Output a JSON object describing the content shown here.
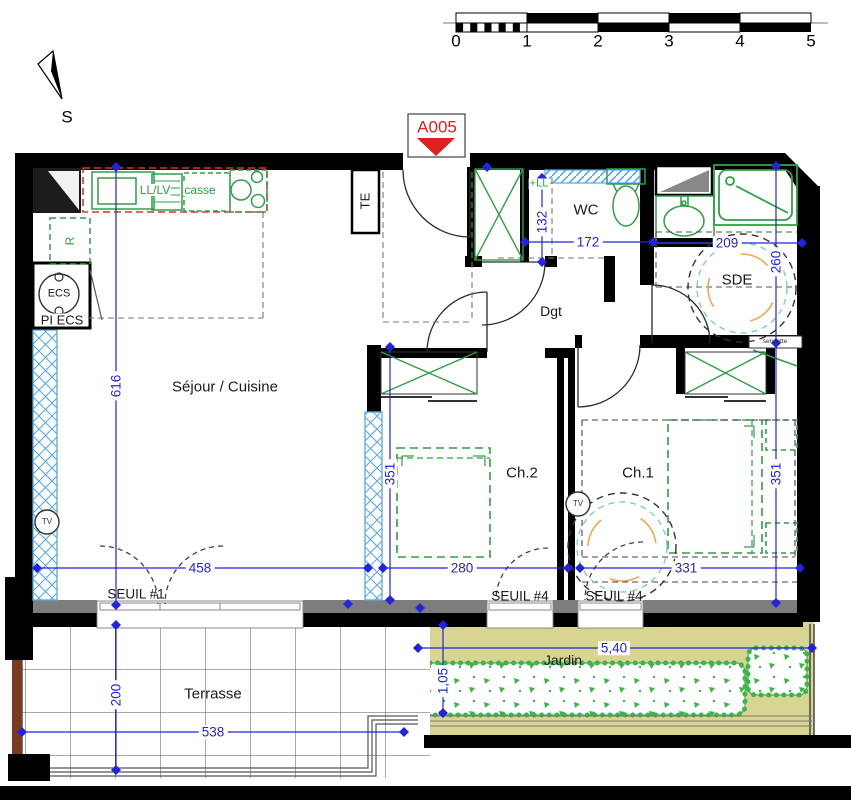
{
  "marker": {
    "plan_id": "A005"
  },
  "compass": {
    "label": "S"
  },
  "scale_bar": {
    "ticks": [
      "0",
      "1",
      "2",
      "3",
      "4",
      "5"
    ]
  },
  "rooms": {
    "sejour_cuisine": "Séjour / Cuisine",
    "wc": "WC",
    "sde": "SDE",
    "dgt": "Dgt",
    "ch2": "Ch.2",
    "ch1": "Ch.1",
    "terrasse": "Terrasse",
    "jardin": "Jardin"
  },
  "fixtures": {
    "electrical_panel": "TE",
    "washer_dishwasher": "LL/LV",
    "pot_drawer": "casse",
    "fridge": "R",
    "water_heater": "ECS",
    "water_heater_closet": "PI ECS",
    "washer_slot": "+LL",
    "tv_outlet_1": "TV",
    "tv_outlet_2": "TV",
    "towel_rail": "serviette"
  },
  "thresholds": {
    "seuil_1": "SEUIL #1",
    "seuil_4a": "SEUIL #4",
    "seuil_4b": "SEUIL #4"
  },
  "dims": {
    "sejour_height": "616",
    "washer_width": "132",
    "wc_width": "172",
    "sde_width": "209",
    "sde_height": "260",
    "ch2_height": "351",
    "ch2_width": "280",
    "ch1_width": "331",
    "ch1_height": "351",
    "sejour_width": "458",
    "terrasse_width": "538",
    "terrasse_height": "200",
    "jardin_width": "5,40",
    "jardin_depth": "1,05"
  },
  "colors": {
    "dim_blue": "#2323dd",
    "fixture_green": "#2fa044",
    "marker_red": "#e02020",
    "window_blue": "#58a8e8",
    "garden_khaki": "#d8d492",
    "hedge_green": "#3cb54a",
    "wall_black": "#000000",
    "wall_gray": "#7d7d7d",
    "circle_teal": "#7fd0c0",
    "circle_orange": "#f0a850"
  }
}
